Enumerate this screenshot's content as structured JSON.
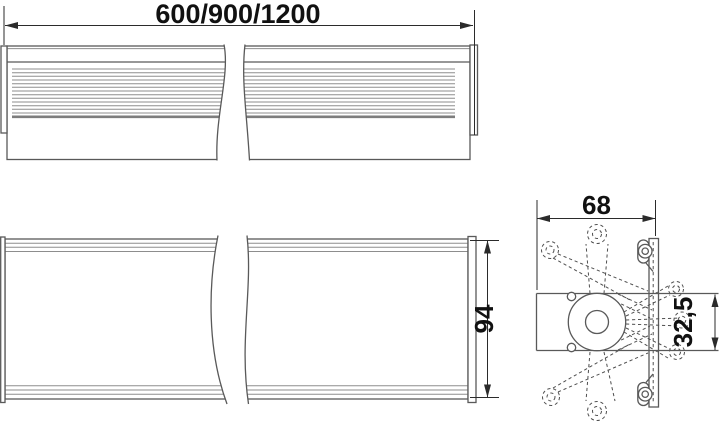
{
  "drawing": {
    "type": "technical-drawing",
    "views": {
      "top": {
        "length_label": "600/900/1200"
      },
      "front": {
        "height_label": "94"
      },
      "side": {
        "width_label": "68",
        "offset_label": "32,5"
      }
    },
    "colors": {
      "background": "#ffffff",
      "outline": "#595959",
      "thin_line": "#8d8d8d",
      "dimension_line": "#2b2b2b",
      "text": "#111111"
    }
  }
}
